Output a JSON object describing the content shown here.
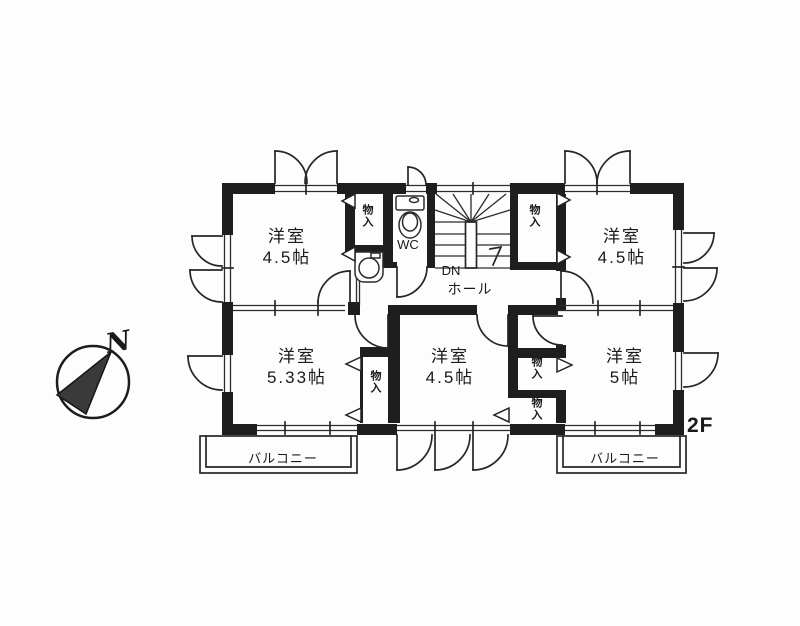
{
  "floor_plan": {
    "floor_label": "2F",
    "compass_label": "N",
    "rooms": [
      {
        "id": "top-left",
        "label": "洋室",
        "size": "4.5帖"
      },
      {
        "id": "top-right",
        "label": "洋室",
        "size": "4.5帖"
      },
      {
        "id": "bottom-left",
        "label": "洋室",
        "size": "5.33帖"
      },
      {
        "id": "bottom-middle",
        "label": "洋室",
        "size": "4.5帖"
      },
      {
        "id": "bottom-right",
        "label": "洋室",
        "size": "5帖"
      }
    ],
    "closets": [
      {
        "label": "物入"
      },
      {
        "label": "物入"
      },
      {
        "label": "物入"
      },
      {
        "label": "物入"
      },
      {
        "label": "物入"
      }
    ],
    "wc_label": "WC",
    "stairs": {
      "down_label": "DN",
      "hall_label": "ホール"
    },
    "balconies": [
      {
        "label": "バルコニー"
      },
      {
        "label": "バルコニー"
      }
    ]
  }
}
